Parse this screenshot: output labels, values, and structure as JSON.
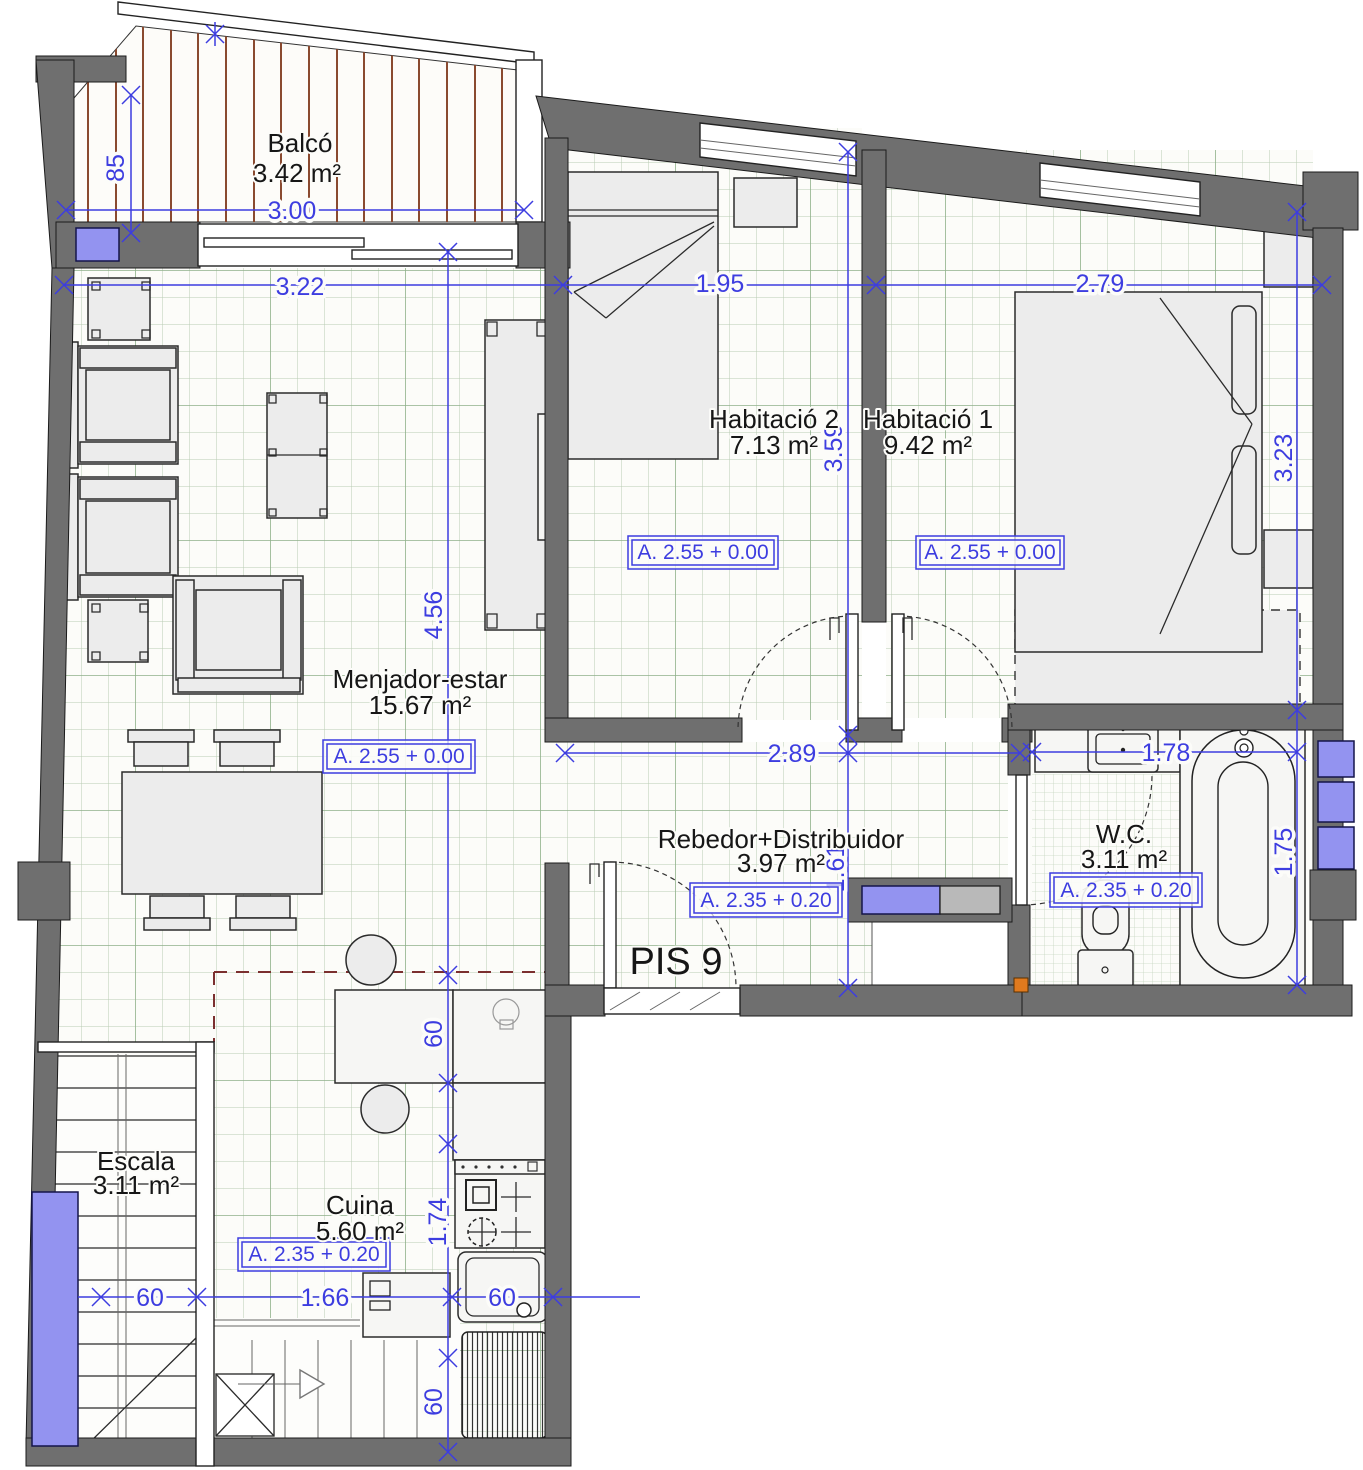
{
  "plan": {
    "title": "PIS 9",
    "rooms": {
      "balco": {
        "name": "Balcó",
        "area": "3.42 m²"
      },
      "habitacio2": {
        "name": "Habitació 2",
        "area": "7.13 m²",
        "level": "A. 2.55 + 0.00"
      },
      "habitacio1": {
        "name": "Habitació 1",
        "area": "9.42 m²",
        "level": "A. 2.55 + 0.00"
      },
      "menjador": {
        "name": "Menjador-estar",
        "area": "15.67 m²",
        "level": "A. 2.55 + 0.00"
      },
      "rebedor": {
        "name": "Rebedor+Distribuidor",
        "area": "3.97 m²",
        "level": "A. 2.35 + 0.20"
      },
      "wc": {
        "name": "W.C.",
        "area": "3.11 m²",
        "level": "A. 2.35 + 0.20"
      },
      "escala": {
        "name": "Escala",
        "area": "3.11 m²"
      },
      "cuina": {
        "name": "Cuina",
        "area": "5.60 m²",
        "level": "A. 2.35 + 0.20"
      }
    },
    "dims": {
      "balcony_width": "3.00",
      "balcony_depth": "85",
      "living_width": "3.22",
      "hab2_width": "1.95",
      "hab1_width": "2.79",
      "hab2_depth": "3.59",
      "hab1_depth": "3.23",
      "living_depth": "4.56",
      "hall_width": "2.89",
      "hall_depth": "1.61",
      "wc_width": "1.78",
      "wc_depth": "1.75",
      "counter_depth": "60",
      "stove_run": "1.74",
      "drainer_run": "60",
      "stair_width": "60",
      "kitchen_width": "1.66",
      "sink_width": "60"
    },
    "colors": {
      "dimension_blue": "#3d3de0",
      "wall_gray": "#6f6f6f",
      "window_blue": "#9393f0",
      "grid_green": "#b9cbb4",
      "deck_brown": "#8a4a30"
    }
  }
}
